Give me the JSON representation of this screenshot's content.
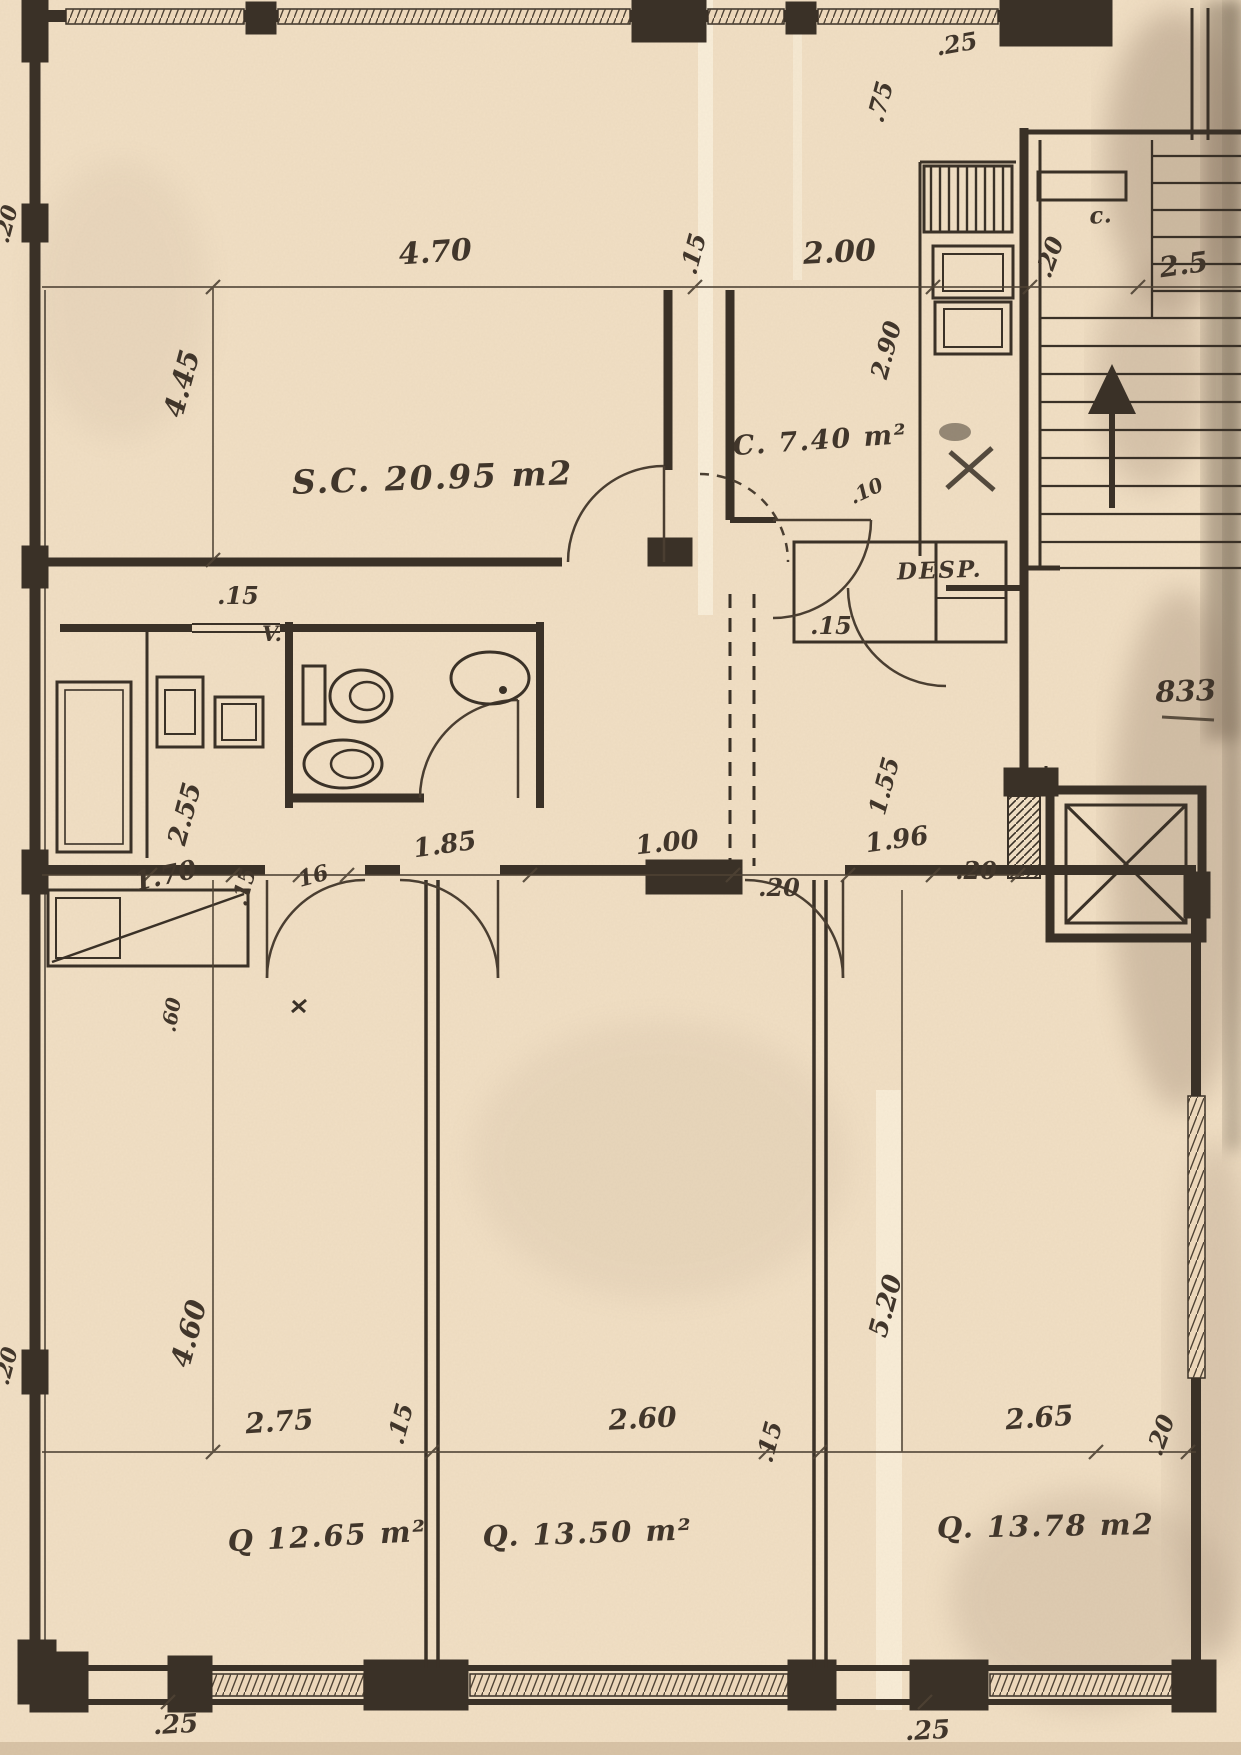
{
  "document": {
    "kind": "scanned architectural floor plan",
    "palette": {
      "paper": "#ecd7ba",
      "ink": "#3a3127",
      "dim_ink": "#4e4234",
      "stain": "#8a7360"
    }
  },
  "rooms": [
    {
      "id": "living",
      "label": "S.C. 20.95 m2"
    },
    {
      "id": "kitchen",
      "label": "C. 7.40 m²"
    },
    {
      "id": "pantry",
      "label": "DESP."
    },
    {
      "id": "bedroom1",
      "label": "Q 12.65 m²"
    },
    {
      "id": "bedroom2",
      "label": "Q. 13.50 m²"
    },
    {
      "id": "bedroom3",
      "label": "Q. 13.78 m2"
    }
  ],
  "annotations": {
    "vent": "V.",
    "closet": "c.",
    "stair_number": "833"
  },
  "dims": [
    {
      "t": "4.70"
    },
    {
      "t": ".15"
    },
    {
      "t": "2.00"
    },
    {
      "t": ".25"
    },
    {
      "t": ".75"
    },
    {
      "t": ".20"
    },
    {
      "t": "2.5"
    },
    {
      "t": "4.45"
    },
    {
      "t": "2.90"
    },
    {
      "t": ".10"
    },
    {
      "t": ".15"
    },
    {
      "t": ".15"
    },
    {
      "t": "2.55"
    },
    {
      "t": "1.70"
    },
    {
      "t": ".15"
    },
    {
      "t": "16"
    },
    {
      "t": "1.85"
    },
    {
      "t": "1.00"
    },
    {
      "t": ".20"
    },
    {
      "t": "1.96"
    },
    {
      "t": ".20"
    },
    {
      "t": "1.55"
    },
    {
      "t": "4.60"
    },
    {
      "t": "2.75"
    },
    {
      "t": ".15"
    },
    {
      "t": "2.60"
    },
    {
      "t": ".15"
    },
    {
      "t": "2.65"
    },
    {
      "t": ".20"
    },
    {
      "t": "5.20"
    },
    {
      "t": ".25"
    },
    {
      "t": ".25"
    },
    {
      "t": ".20"
    },
    {
      "t": ".20"
    },
    {
      "t": ".60"
    }
  ]
}
